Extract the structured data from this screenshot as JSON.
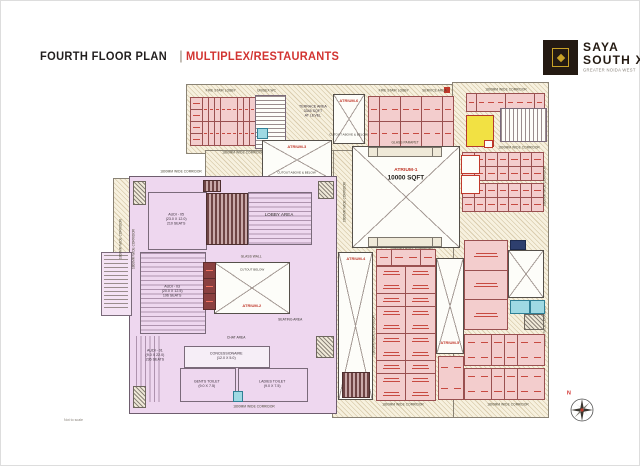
{
  "header": {
    "title": "FOURTH FLOOR PLAN",
    "separator": "|",
    "subtitle": "MULTIPLEX/RESTAURANTS"
  },
  "logo": {
    "name1": "SAYA",
    "name2": "SOUTH X",
    "tagline": "GREATER NOIDA WEST"
  },
  "compass": {
    "north": "N"
  },
  "page": {
    "scale_note": "Not to scale"
  },
  "colors": {
    "accent_red": "#d23431",
    "brand_dark": "#241a12",
    "brand_gold": "#c9a227",
    "multiplex_fill": "#eed7ef",
    "unit_fill": "#f3cdcd",
    "unit_line": "#9a5050",
    "terrace_fill": "#f7f1df",
    "service_cyan": "#9fd9e3",
    "highlight_yellow": "#f2e143"
  },
  "plan": {
    "atrium1": {
      "name": "ATRIUM-1",
      "area": "10000 SQFT"
    },
    "atrium2": {
      "name": "ATRIUM-2",
      "note": "CUTOUT BELOW"
    },
    "atrium3": {
      "name": "ATRIUM-3",
      "note": "CUTOUT ABOVE & BELOW"
    },
    "atrium4": {
      "name": "ATRIUM-4"
    },
    "atrium5": {
      "name": "ATRIUM-5"
    },
    "atrium6": {
      "name": "ATRIUM-6",
      "note": "CUTOUT ABOVE & BELOW"
    },
    "terrace": {
      "line1": "TERRACE AREA",
      "line2": "3345 SQFT",
      "line3": "AT LEVEL"
    },
    "multiplex": {
      "audi5": {
        "name": "AUDI - 05",
        "dims": "(23.0 X 12.0)",
        "seats": "210 SEATS"
      },
      "audi3": {
        "name": "AUDI - 03",
        "dims": "(20.0 X 12.5)",
        "seats": "196 SEATS"
      },
      "audi1": {
        "name": "AUDI - 01",
        "dims": "(9.0 X 22.0)",
        "seats": "236 SEATS"
      },
      "lobby": "LOBBY AREA",
      "seating": "SEATING AREA",
      "chat": "CHAT AREA",
      "glass_wall": "GLASS WALL",
      "concessionaire": {
        "name": "CONCESSIONAIRE",
        "dims": "(12.0 X 5.0)"
      },
      "gents_toilet": {
        "name": "GENTS TOILET",
        "dims": "(9.0 X 7.5)"
      },
      "ladies_toilet": {
        "name": "LADIES TOILET",
        "dims": "(9.0 X 7.5)"
      }
    },
    "labels": {
      "corridor": "1800MM WIDE CORRIDOR",
      "glass_parapet": "GLASS PARAPET",
      "fire_stair_lobby": "FIRE STAIR LOBBY",
      "unisex_wc": "UNISEX WC",
      "service_area": "SERVICE AREA"
    }
  }
}
